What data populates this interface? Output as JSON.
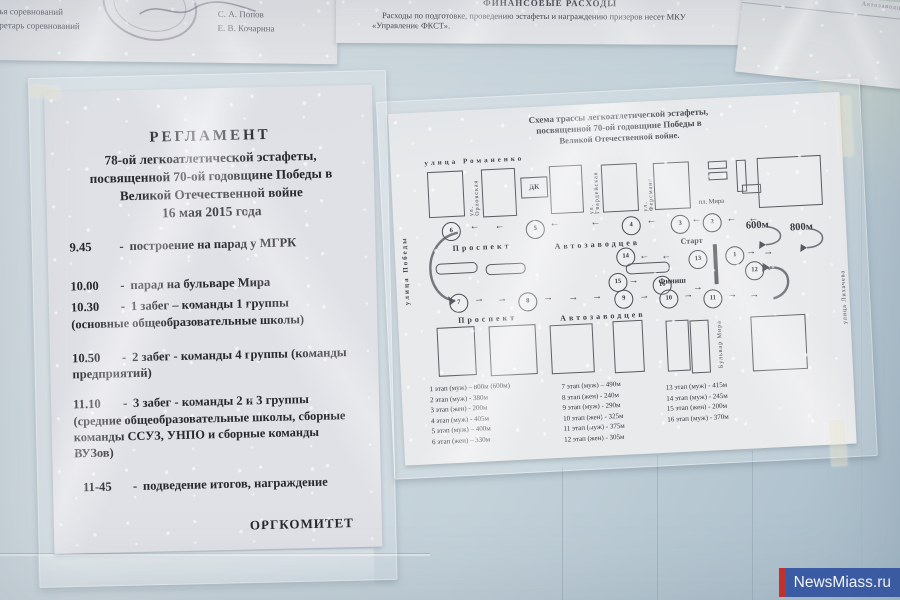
{
  "watermark": {
    "text": "NewsMiass.ru",
    "bg_color": "#3a5ca8",
    "bar_color": "#c9302c"
  },
  "officials_note": {
    "role1": "Главный судья соревнований",
    "role2": "Главный секретарь соревнований",
    "name1": "С. А. Попов",
    "name2": "Е. В. Кочарина"
  },
  "finance_note": {
    "title": "ФИНАНСОВЫЕ РАСХОДЫ",
    "line1": "Расходы по подготовке, проведению эстафеты и награждению призеров несет МКУ",
    "line2": "«Управление ФКСТ»."
  },
  "scrap_note": {
    "text": "Автозаводцев"
  },
  "reglament": {
    "title": "РЕГЛАМЕНТ",
    "subtitle1": "78-ой легкоатлетической эстафеты,",
    "subtitle2": "посвященной 70-ой годовщине Победы в",
    "subtitle3": "Великой Отечественной войне",
    "date_line": "16 мая  2015 года",
    "sep": "-",
    "schedule": [
      {
        "time": "9.45",
        "text": "построение  на  парад  у  МГРК"
      },
      {
        "time": "10.00",
        "text": "парад  на бульваре Мира"
      },
      {
        "time": "10.30",
        "text": "1 забег – команды  1  группы",
        "note": "(основные общеобразовательные  школы)"
      },
      {
        "time": "10.50",
        "text": "2 забег  -  команды 4 группы (команды предприятий)"
      },
      {
        "time": "11.10",
        "text": "3 забег  -  команды 2 и 3 группы",
        "note": "(средние общеобразовательные   школы, сборные команды ССУЗ,   УНПО  и   сборные  команды ВУЗов)"
      },
      {
        "time": "11-45",
        "text": "подведение итогов, награждение"
      }
    ],
    "signoff": "ОРГКОМИТЕТ"
  },
  "schema": {
    "title1": "Схема трассы легкоатлетической эстафеты,",
    "title2": "посвященной 70-ой годовщине Победы в",
    "title3": "Великой Отечественной войне.",
    "streets": {
      "romanenko": "улица Романенко",
      "orlovskaya": "ул. Орловская",
      "gvardeyskaya": "ул. Гвардейская",
      "fersmana": "ул. Ферсмана",
      "pl_mira": "пл. Мира",
      "pobedy": "улица Победы",
      "bulvar_mira": "Бульвар Мира",
      "likhacheva": "улица Лихачева",
      "dk": "ДК",
      "prospekt": "Проспект",
      "avtozavodtsev": "Автозаводцев"
    },
    "start_label": "Старт",
    "finish_label": "Финиш",
    "dist600": "600м",
    "dist800": "800м",
    "arrow_left": "←",
    "arrow_right": "→",
    "stage_numbers": [
      "1",
      "2",
      "3",
      "4",
      "5",
      "6",
      "7",
      "8",
      "9",
      "10",
      "11",
      "12",
      "13",
      "14",
      "15",
      "16"
    ],
    "legend": {
      "col1": [
        "1 этап (муж) – 800м  (600м)",
        "2 этап (муж)  - 380м",
        "3 этап (жен)   - 200м",
        "4 этап (муж)  - 405м",
        "5 этап (муж) – 400м",
        "6 этап (жен) – 330м"
      ],
      "col2": [
        "7 этап (муж) – 490м",
        "8 этап (жен) -  240м",
        "9 этап (муж)  -  290м",
        "10 этап (жен) -  325м",
        "11 этап (муж) -  375м",
        "12 этап (жен)  -  305м"
      ],
      "col3": [
        "13 этап (муж)  - 415м",
        "14 этап (муж) - 245м",
        "15 этап (жен)  -  200м",
        "16 этап (муж) - 370м"
      ]
    }
  }
}
